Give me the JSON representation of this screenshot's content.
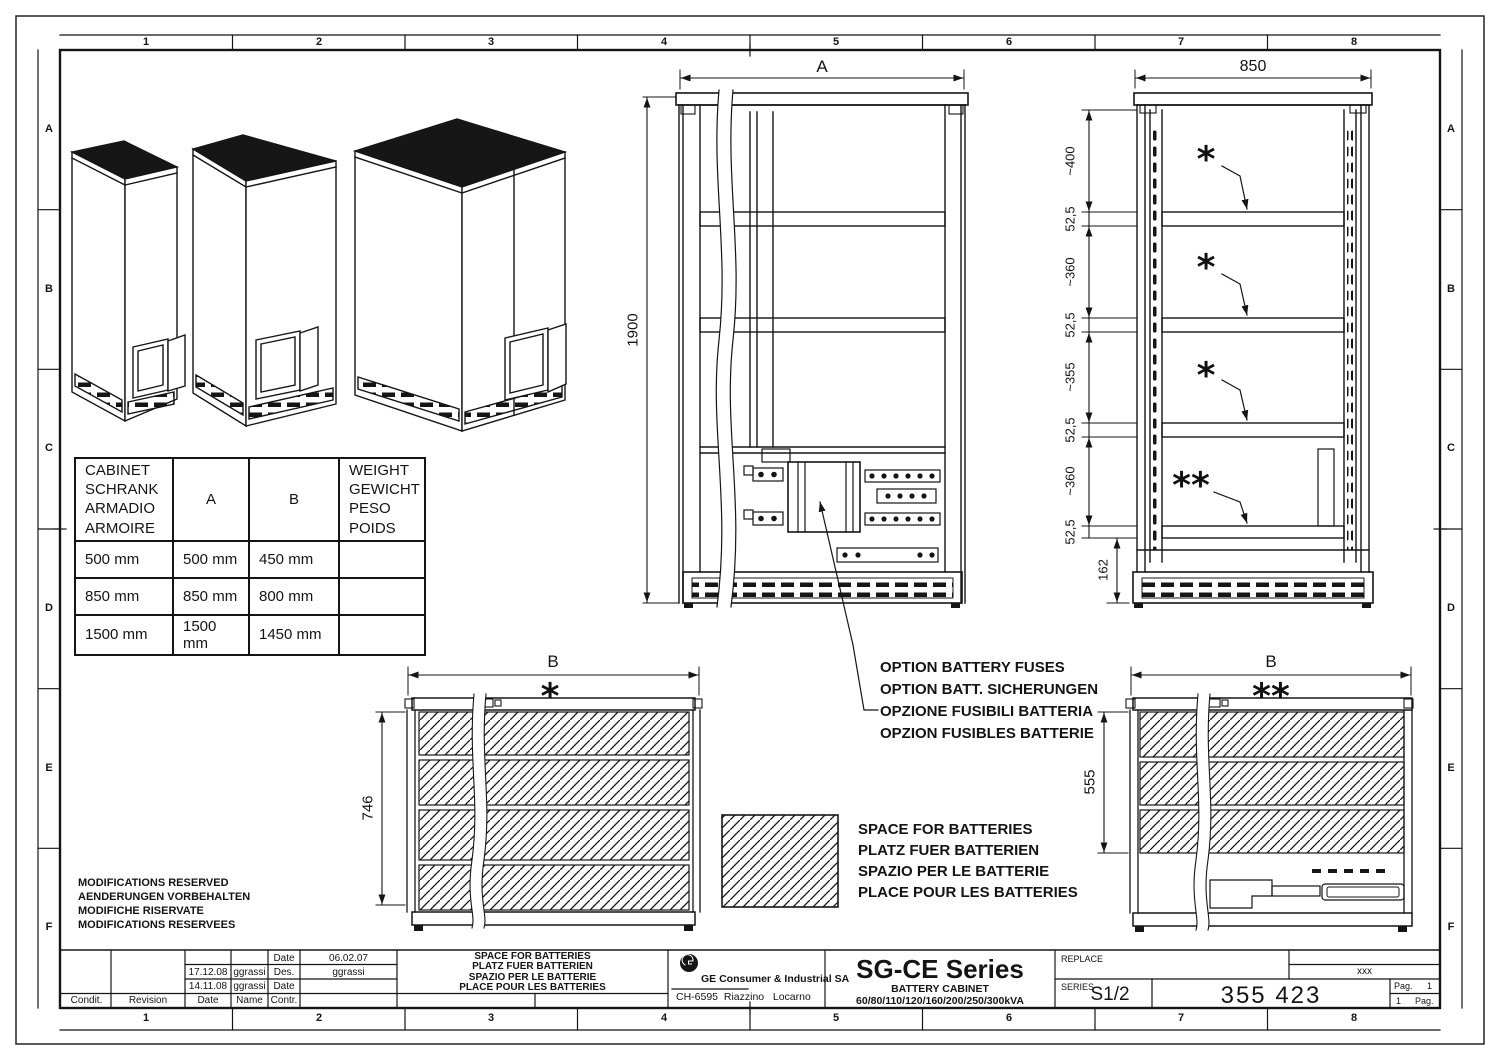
{
  "sheet": {
    "grid_columns": [
      "1",
      "2",
      "3",
      "4",
      "5",
      "6",
      "7",
      "8"
    ],
    "grid_rows": [
      "A",
      "B",
      "C",
      "D",
      "E",
      "F"
    ],
    "modifications_note": [
      "MODIFICATIONS RESERVED",
      "AENDERUNGEN VORBEHALTEN",
      "MODIFICHE RISERVATE",
      "MODIFICATIONS RESERVEES"
    ]
  },
  "cabinet_table": {
    "header_cabinet": [
      "CABINET",
      "SCHRANK",
      "ARMADIO",
      "ARMOIRE"
    ],
    "header_a": "A",
    "header_b": "B",
    "header_weight": [
      "WEIGHT",
      "GEWICHT",
      "PESO",
      "POIDS"
    ],
    "rows": [
      {
        "cabinet": "500 mm",
        "a": "500 mm",
        "b": "450 mm",
        "weight": ""
      },
      {
        "cabinet": "850 mm",
        "a": "850 mm",
        "b": "800 mm",
        "weight": ""
      },
      {
        "cabinet": "1500 mm",
        "a": "1500 mm",
        "b": "1450 mm",
        "weight": ""
      }
    ]
  },
  "front_view": {
    "width_label": "A",
    "height_label": "1900"
  },
  "side_view": {
    "width_label": "850",
    "height_dims": [
      "~400",
      "52,5",
      "~360",
      "52,5",
      "~355",
      "52,5",
      "~360",
      "52,5"
    ],
    "plinth_dim": "162",
    "shelf_marker": "*",
    "tray_marker": "**"
  },
  "plan_left": {
    "width_label": "B",
    "marker": "*",
    "depth_label": "746"
  },
  "plan_right": {
    "width_label": "B",
    "marker": "**",
    "depth_label": "555"
  },
  "option_note": [
    "OPTION BATTERY FUSES",
    "OPTION BATT. SICHERUNGEN",
    "OPZIONE FUSIBILI BATTERIA",
    "OPZION FUSIBLES BATTERIE"
  ],
  "battery_legend": [
    "SPACE FOR BATTERIES",
    "PLATZ FUER BATTERIEN",
    "SPAZIO PER LE BATTERIE",
    "PLACE POUR LES BATTERIES"
  ],
  "title_block": {
    "revision": {
      "r1": {
        "label": "Date",
        "value": "06.02.07"
      },
      "r2": {
        "date": "17.12.08",
        "name": "ggrassi",
        "label": "Des.",
        "value": "ggrassi"
      },
      "r3": {
        "date": "14.11.08",
        "name": "ggrassi",
        "label": "Date",
        "value": ""
      },
      "headers": [
        "Condit.",
        "Revision",
        "Date",
        "Name",
        "Contr."
      ]
    },
    "title_lines": [
      "SPACE FOR BATTERIES",
      "PLATZ FUER BATTERIEN",
      "SPAZIO PER LE BATTERIE",
      "PLACE POUR LES BATTERIES"
    ],
    "company_name": "GE Consumer & Industrial SA",
    "company_address": "CH-6595  Riazzino   Locarno",
    "product_series": "SG-CE Series",
    "product_type": "BATTERY CABINET",
    "product_ratings": "60/80/110/120/160/200/250/300kVA",
    "replace_label": "REPLACE",
    "replace_value": "xxx",
    "series_label": "SERIES",
    "series_value": "S1/2",
    "drawing_number": "355 423",
    "pag": {
      "top_label": "Pag.",
      "top_value": "1",
      "bottom_value": "1",
      "bottom_label": "Pag."
    }
  }
}
